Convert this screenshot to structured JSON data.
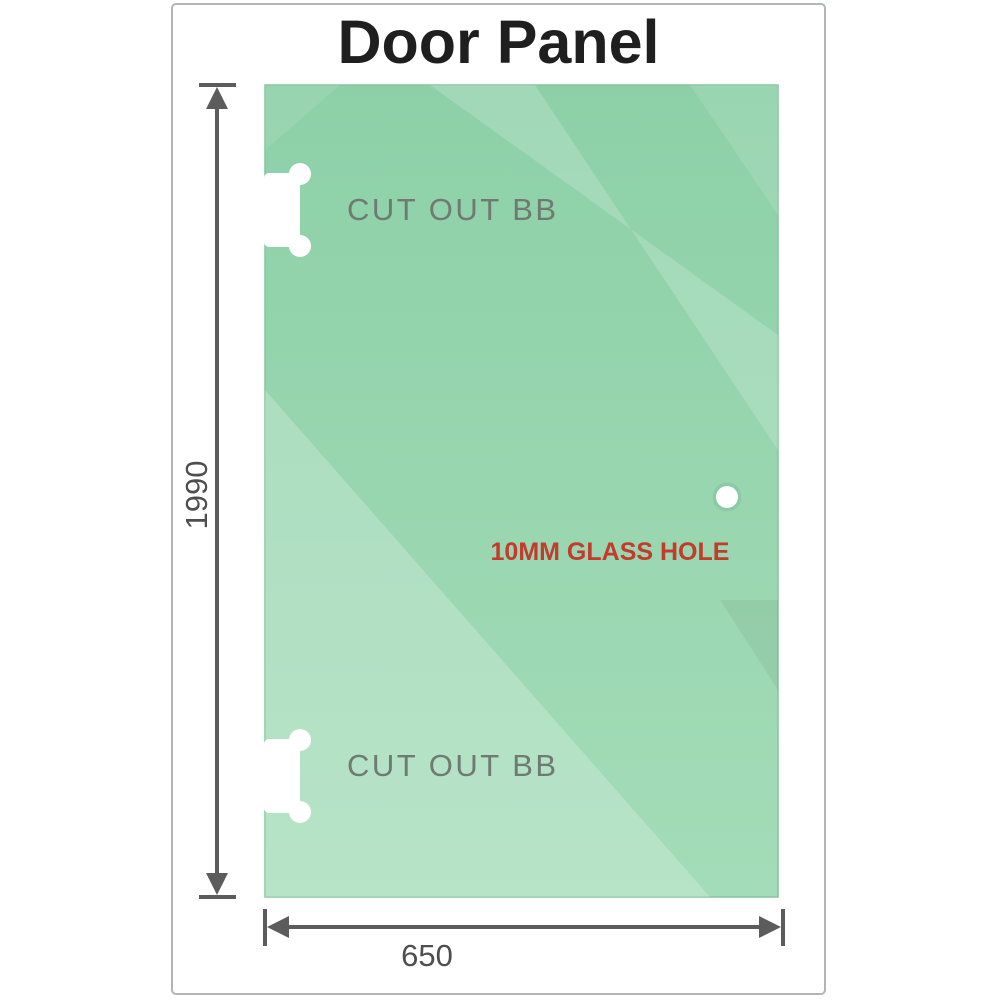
{
  "title": "Door Panel",
  "dimensions": {
    "height": "1990",
    "width": "650"
  },
  "annotations": {
    "cutout_top": "CUT OUT BB",
    "cutout_bottom": "CUT OUT BB",
    "glass_hole": "10MM GLASS HOLE"
  },
  "colors": {
    "glass_green_top": "#8dd0a8",
    "glass_green_bottom": "#a3dcb8",
    "glass_highlight": "#b9e6ca",
    "dimension_gray": "#5c5c5c",
    "dimension_text_gray": "#4e4e4e",
    "cutout_label_gray": "#6f7a73",
    "hole_label_red": "#c23b2c",
    "title_black": "#1f1f1f",
    "frame_border_gray": "#b2b6b2",
    "cutout_white": "#ffffff"
  }
}
